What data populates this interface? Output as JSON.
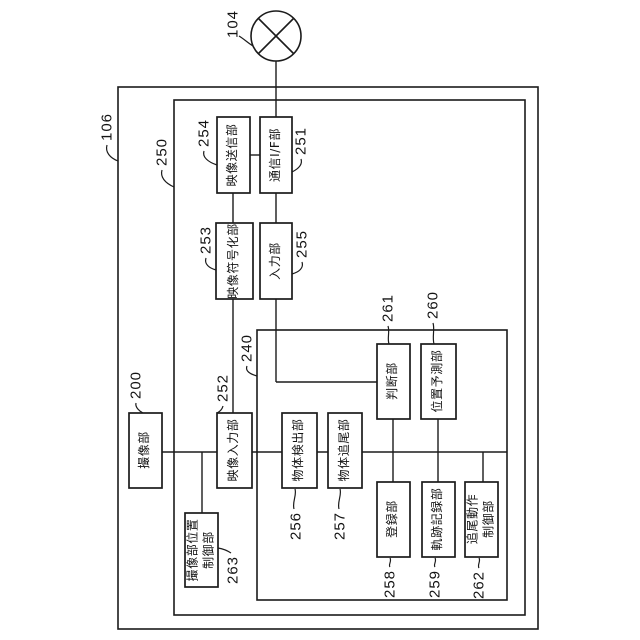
{
  "figure": {
    "background": "#ffffff",
    "ink": "#1b1b1b"
  },
  "network_node": {
    "ref": "104"
  },
  "containers": {
    "c106": {
      "ref": "106"
    },
    "c250": {
      "ref": "250"
    },
    "c240": {
      "ref": "240"
    }
  },
  "blocks": {
    "b200": {
      "ref": "200",
      "label": "撮像部"
    },
    "b263": {
      "ref": "263",
      "label": "撮像部位置\n制御部"
    },
    "b252": {
      "ref": "252",
      "label": "映像入力部"
    },
    "b254": {
      "ref": "254",
      "label": "映像送信部"
    },
    "b251": {
      "ref": "251",
      "label": "通信I/F部"
    },
    "b253": {
      "ref": "253",
      "label": "映像符号化部"
    },
    "b255": {
      "ref": "255",
      "label": "入力部"
    },
    "b256": {
      "ref": "256",
      "label": "物体検出部"
    },
    "b257": {
      "ref": "257",
      "label": "物体追尾部"
    },
    "b261": {
      "ref": "261",
      "label": "判断部"
    },
    "b260": {
      "ref": "260",
      "label": "位置予測部"
    },
    "b258": {
      "ref": "258",
      "label": "登録部"
    },
    "b259": {
      "ref": "259",
      "label": "軌跡記録部"
    },
    "b262": {
      "ref": "262",
      "label": "追尾動作\n制御部"
    }
  }
}
